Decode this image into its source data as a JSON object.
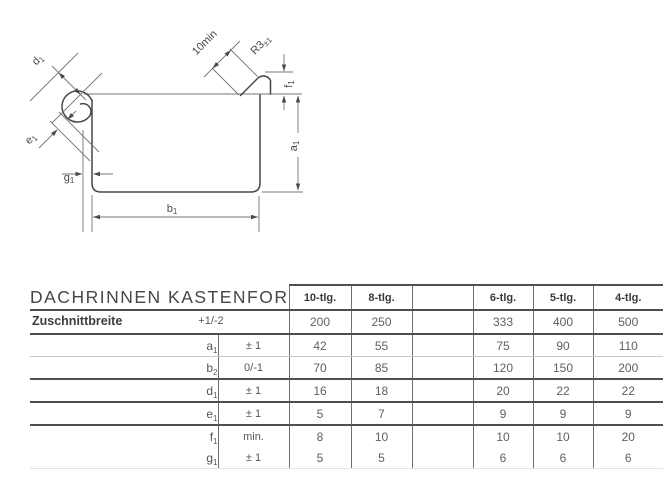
{
  "drawing": {
    "dims": {
      "d1": {
        "base": "d",
        "sub": "1"
      },
      "e1": {
        "base": "e",
        "sub": "1"
      },
      "g1": {
        "base": "g",
        "sub": "1"
      },
      "b1": {
        "base": "b",
        "sub": "1"
      },
      "a1": {
        "base": "a",
        "sub": "1"
      },
      "f1": {
        "base": "f",
        "sub": "1"
      },
      "flange": "10min",
      "radius": {
        "base": "R3",
        "sub": "±1"
      }
    }
  },
  "table": {
    "title": "DACHRINNEN KASTENFORM",
    "col_headers": [
      "10-tlg.",
      "8-tlg.",
      "",
      "6-tlg.",
      "5-tlg.",
      "4-tlg."
    ],
    "zuschnitt": {
      "label": "Zuschnittbreite",
      "tolerance": "+1/-2",
      "values": [
        "200",
        "250",
        "",
        "333",
        "400",
        "500"
      ]
    },
    "rows": [
      {
        "label": {
          "base": "a",
          "sub": "1"
        },
        "tolerance": "± 1",
        "values": [
          "42",
          "55",
          "",
          "75",
          "90",
          "110"
        ]
      },
      {
        "label": {
          "base": "b",
          "sub": "2"
        },
        "tolerance": "0/-1",
        "values": [
          "70",
          "85",
          "",
          "120",
          "150",
          "200"
        ]
      },
      {
        "label": {
          "base": "d",
          "sub": "1"
        },
        "tolerance": "± 1",
        "values": [
          "16",
          "18",
          "",
          "20",
          "22",
          "22"
        ]
      },
      {
        "label": {
          "base": "e",
          "sub": "1"
        },
        "tolerance": "± 1",
        "values": [
          "5",
          "7",
          "",
          "9",
          "9",
          "9"
        ]
      },
      {
        "label": {
          "base": "f",
          "sub": "1"
        },
        "tolerance": "min.",
        "values": [
          "8",
          "10",
          "",
          "10",
          "10",
          "20"
        ]
      },
      {
        "label": {
          "base": "g",
          "sub": "1"
        },
        "tolerance": "± 1",
        "values": [
          "5",
          "5",
          "",
          "6",
          "6",
          "6"
        ]
      }
    ]
  }
}
